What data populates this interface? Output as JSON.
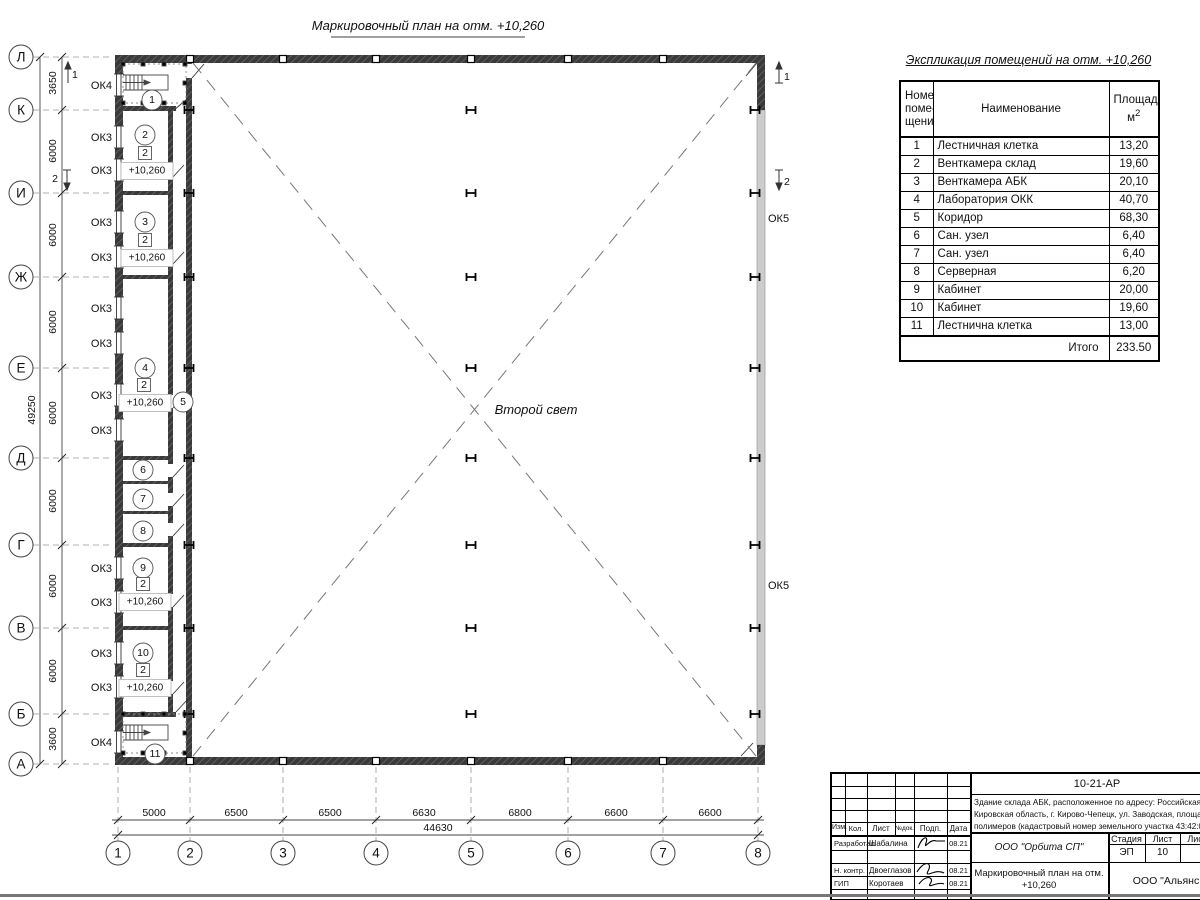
{
  "plan": {
    "title": "Маркировочный план на отм. +10,260",
    "second_light": "Второй свет",
    "axis_rows": [
      "Л",
      "К",
      "И",
      "Ж",
      "Е",
      "Д",
      "Г",
      "В",
      "Б",
      "А"
    ],
    "row_dims": [
      "3650",
      "6000",
      "6000",
      "6000",
      "6000",
      "6000",
      "6000",
      "6000",
      "3600"
    ],
    "total_row_dim": "49250",
    "axis_cols": [
      "1",
      "2",
      "3",
      "4",
      "5",
      "6",
      "7",
      "8"
    ],
    "col_dims": [
      "5000",
      "6500",
      "6500",
      "6630",
      "6800",
      "6600",
      "6600"
    ],
    "total_col_dim": "44630",
    "rooms": [
      "1",
      "2",
      "3",
      "4",
      "5",
      "6",
      "7",
      "8",
      "9",
      "10",
      "11"
    ],
    "type_mark": "2",
    "elevation": "+10,260",
    "window_marks": {
      "ok3": "ОК3",
      "ok4": "ОК4",
      "ok5": "ОК5"
    },
    "section_marks": {
      "s1": "1",
      "s2": "2"
    }
  },
  "schedule": {
    "title": "Экспликация помещений на отм. +10,260",
    "headers": {
      "num0": "Номер",
      "num1": "поме-",
      "num2": "щения",
      "name": "Наименование",
      "area": "Площадь,",
      "area_unit": "м",
      "area_sup": "2"
    },
    "rows": [
      {
        "num": "1",
        "name": "Лестничная клетка",
        "area": "13,20"
      },
      {
        "num": "2",
        "name": "Венткамера склад",
        "area": "19,60"
      },
      {
        "num": "3",
        "name": "Венткамера АБК",
        "area": "20,10"
      },
      {
        "num": "4",
        "name": "Лаборатория ОКК",
        "area": "40,70"
      },
      {
        "num": "5",
        "name": "Коридор",
        "area": "68,30"
      },
      {
        "num": "6",
        "name": "Сан. узел",
        "area": "6,40"
      },
      {
        "num": "7",
        "name": "Сан. узел",
        "area": "6,40"
      },
      {
        "num": "8",
        "name": "Серверная",
        "area": "6,20"
      },
      {
        "num": "9",
        "name": "Кабинет",
        "area": "20,00"
      },
      {
        "num": "10",
        "name": "Кабинет",
        "area": "19,60"
      },
      {
        "num": "11",
        "name": "Лестнична клетка",
        "area": "13,00"
      }
    ],
    "total_label": "Итого",
    "total": "233.50"
  },
  "title_block": {
    "doc_code": "10-21-АР",
    "description": [
      "Здание склада АБК, расположенное по адресу: Российская Феде",
      "Кировская область, г. Кирово-Чепецк, ул. Заводская, площадка з",
      "полимеров (кадастровый номер земельного участка 43:42:0000"
    ],
    "columns": [
      "Изм.",
      "Кол.",
      "Лист",
      "№док.",
      "Подп.",
      "Дата"
    ],
    "people": [
      {
        "role": "Разработал",
        "name": "Шабалина",
        "date": "08.21"
      },
      {
        "role": "Н. контр.",
        "name": "Двоеглазов",
        "date": "08.21"
      },
      {
        "role": "ГИП",
        "name": "Коротаев",
        "date": "08.21"
      }
    ],
    "company": "ООО \"Орбита СП\"",
    "stage": {
      "headers": [
        "Стадия",
        "Лист",
        "Листов"
      ],
      "values": [
        "ЭП",
        "10",
        "1"
      ]
    },
    "sheet_title_lines": [
      "Маркировочный план на отм.",
      "+10,260"
    ],
    "company2": "ООО \"Альянс"
  }
}
